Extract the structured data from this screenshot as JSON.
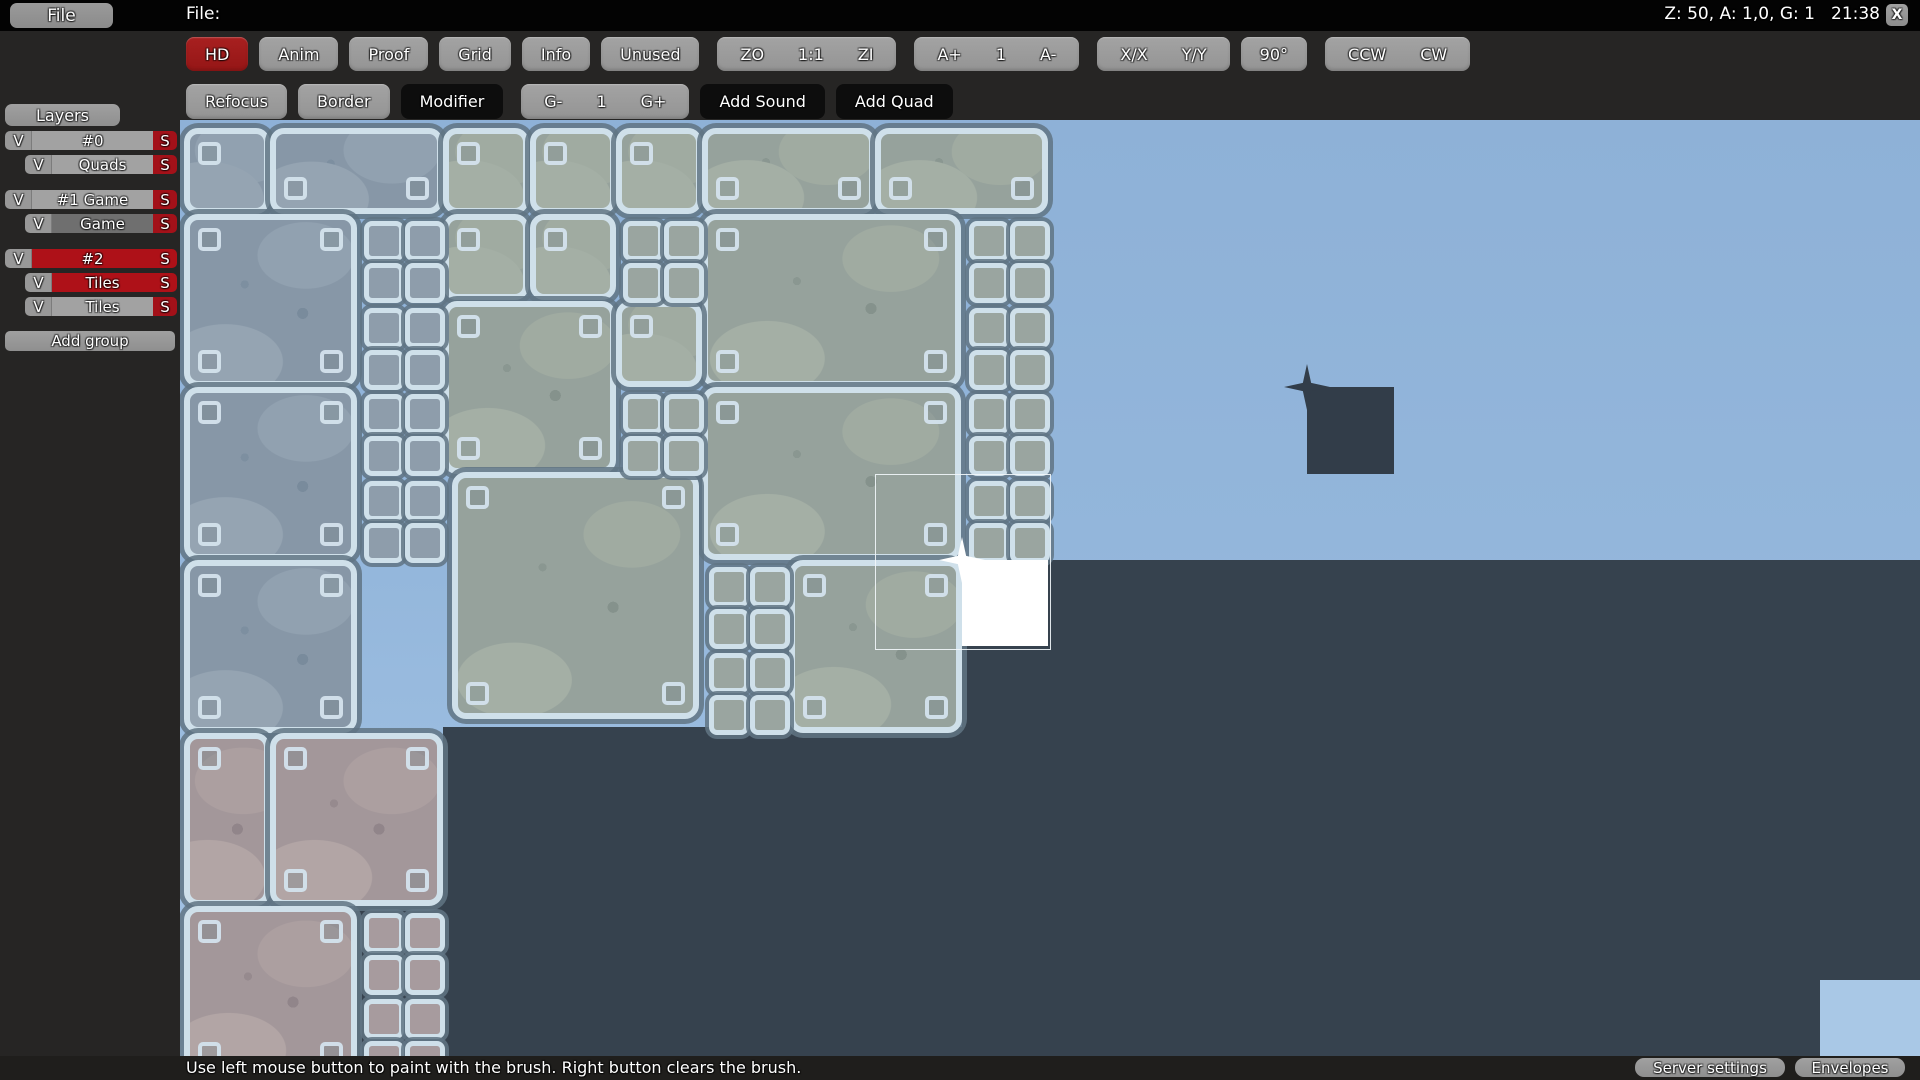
{
  "topbar": {
    "file_button": "File",
    "file_label": "File:",
    "zoom_info": "Z: 50, A: 1,0, G: 1",
    "clock": "21:38",
    "close": "X"
  },
  "toolbar": {
    "row1": [
      {
        "kind": "button",
        "label": "HD",
        "variant": "red",
        "name": "hd-toggle"
      },
      {
        "kind": "button",
        "label": "Anim",
        "variant": "grey",
        "name": "anim-toggle"
      },
      {
        "kind": "button",
        "label": "Proof",
        "variant": "grey",
        "name": "proof-toggle"
      },
      {
        "kind": "button",
        "label": "Grid",
        "variant": "grey",
        "name": "grid-toggle"
      },
      {
        "kind": "button",
        "label": "Info",
        "variant": "grey",
        "name": "info-toggle"
      },
      {
        "kind": "button",
        "label": "Unused",
        "variant": "grey",
        "name": "unused-toggle"
      },
      {
        "kind": "group",
        "name": "zoom-group",
        "labels": [
          "ZO",
          "1:1",
          "ZI"
        ]
      },
      {
        "kind": "group",
        "name": "animation-speed-group",
        "labels": [
          "A+",
          "1",
          "A-"
        ]
      },
      {
        "kind": "group",
        "name": "flip-group",
        "labels": [
          "X/X",
          "Y/Y"
        ]
      },
      {
        "kind": "button",
        "label": "90°",
        "variant": "grey",
        "name": "rotate-amount-button"
      },
      {
        "kind": "group",
        "name": "rotate-group",
        "labels": [
          "CCW",
          "CW"
        ]
      }
    ],
    "row2": [
      {
        "kind": "button",
        "label": "Refocus",
        "variant": "grey",
        "name": "refocus-button"
      },
      {
        "kind": "button",
        "label": "Border",
        "variant": "grey",
        "name": "border-button"
      },
      {
        "kind": "button",
        "label": "Modifier",
        "variant": "dark",
        "name": "modifier-button"
      },
      {
        "kind": "group",
        "name": "grid-size-group",
        "labels": [
          "G-",
          "1",
          "G+"
        ]
      },
      {
        "kind": "button",
        "label": "Add Sound",
        "variant": "dark",
        "name": "add-sound-button"
      },
      {
        "kind": "button",
        "label": "Add Quad",
        "variant": "dark",
        "name": "add-quad-button"
      }
    ]
  },
  "layers": {
    "header": "Layers",
    "visibility_label": "V",
    "save_label": "S",
    "rows": [
      {
        "label": "#0",
        "indent": false,
        "style": "grey",
        "gap_after": false
      },
      {
        "label": "Quads",
        "indent": true,
        "style": "grey",
        "gap_after": true
      },
      {
        "label": "#1 Game",
        "indent": false,
        "style": "grey",
        "gap_after": false
      },
      {
        "label": "Game",
        "indent": true,
        "style": "darkgrey",
        "gap_after": true
      },
      {
        "label": "#2",
        "indent": false,
        "style": "red",
        "gap_after": false
      },
      {
        "label": "Tiles",
        "indent": true,
        "style": "red",
        "gap_after": false
      },
      {
        "label": "Tiles",
        "indent": true,
        "style": "grey",
        "gap_after": false
      }
    ],
    "add_group": "Add group"
  },
  "statusbar": {
    "hint": "Use left mouse button to paint with the brush. Right button clears the brush.",
    "server_settings": "Server settings",
    "envelopes": "Envelopes"
  },
  "colors": {
    "accent_red": "#9e1b1b",
    "selected_red": "#ae1118",
    "sky_top": "#8eb1d7",
    "sky_bottom": "#a5c5e6",
    "underground": "#36424e",
    "tile_border": "#cfe0ea",
    "tile_blue": "#8797a7",
    "tile_green": "#96a29c",
    "tile_pink": "#a3979a",
    "white_tile": "#ffffff",
    "dark_tile": "#323d49",
    "corner_blue": "#a9c8e6"
  },
  "canvas": {
    "dark_rects": [
      {
        "x": 868,
        "y": 440,
        "w": 872,
        "h": 496
      },
      {
        "x": 782,
        "y": 526,
        "w": 86,
        "h": 410
      },
      {
        "x": 263,
        "y": 607,
        "w": 606,
        "h": 329
      },
      {
        "x": 174,
        "y": 770,
        "w": 90,
        "h": 166
      }
    ],
    "corner_rect": {
      "x": 1640,
      "y": 860,
      "w": 100,
      "h": 76
    },
    "tiles": [
      {
        "x": 4,
        "y": 8,
        "w": 86,
        "h": 86,
        "v": "b"
      },
      {
        "x": 90,
        "y": 8,
        "w": 173,
        "h": 86,
        "v": "b"
      },
      {
        "x": 263,
        "y": 8,
        "w": 86,
        "h": 86,
        "v": "g"
      },
      {
        "x": 350,
        "y": 8,
        "w": 86,
        "h": 86,
        "v": "g"
      },
      {
        "x": 436,
        "y": 8,
        "w": 86,
        "h": 86,
        "v": "g"
      },
      {
        "x": 522,
        "y": 8,
        "w": 173,
        "h": 86,
        "v": "g"
      },
      {
        "x": 695,
        "y": 8,
        "w": 173,
        "h": 86,
        "v": "g"
      },
      {
        "x": 4,
        "y": 94,
        "w": 173,
        "h": 173,
        "v": "b"
      },
      {
        "x": 263,
        "y": 94,
        "w": 86,
        "h": 86,
        "v": "g"
      },
      {
        "x": 350,
        "y": 94,
        "w": 86,
        "h": 86,
        "v": "g"
      },
      {
        "x": 522,
        "y": 94,
        "w": 259,
        "h": 173,
        "v": "g"
      },
      {
        "x": 263,
        "y": 181,
        "w": 173,
        "h": 173,
        "v": "g"
      },
      {
        "x": 436,
        "y": 181,
        "w": 86,
        "h": 86,
        "v": "g"
      },
      {
        "x": 4,
        "y": 267,
        "w": 173,
        "h": 173,
        "v": "b"
      },
      {
        "x": 522,
        "y": 267,
        "w": 259,
        "h": 173,
        "v": "g"
      },
      {
        "x": 272,
        "y": 352,
        "w": 247,
        "h": 247,
        "v": "g"
      },
      {
        "x": 4,
        "y": 440,
        "w": 173,
        "h": 173,
        "v": "b"
      },
      {
        "x": 609,
        "y": 440,
        "w": 173,
        "h": 173,
        "v": "g"
      },
      {
        "x": 4,
        "y": 613,
        "w": 86,
        "h": 173,
        "v": "p"
      },
      {
        "x": 90,
        "y": 613,
        "w": 173,
        "h": 173,
        "v": "p"
      },
      {
        "x": 4,
        "y": 786,
        "w": 173,
        "h": 173,
        "v": "p"
      }
    ],
    "quads": [
      {
        "x": 177,
        "y": 94,
        "v": "b"
      },
      {
        "x": 436,
        "y": 94,
        "v": "g"
      },
      {
        "x": 782,
        "y": 94,
        "v": "g"
      },
      {
        "x": 177,
        "y": 181,
        "v": "b"
      },
      {
        "x": 782,
        "y": 181,
        "v": "g"
      },
      {
        "x": 177,
        "y": 267,
        "v": "b"
      },
      {
        "x": 436,
        "y": 267,
        "v": "g"
      },
      {
        "x": 782,
        "y": 267,
        "v": "g"
      },
      {
        "x": 177,
        "y": 354,
        "v": "b"
      },
      {
        "x": 782,
        "y": 354,
        "v": "g"
      },
      {
        "x": 522,
        "y": 440,
        "v": "g"
      },
      {
        "x": 522,
        "y": 526,
        "v": "g"
      },
      {
        "x": 177,
        "y": 786,
        "v": "p"
      },
      {
        "x": 177,
        "y": 872,
        "v": "p"
      }
    ],
    "white_tile": {
      "x": 782,
      "y": 440,
      "w": 86,
      "h": 86
    },
    "dark_square": {
      "x": 1127,
      "y": 267,
      "w": 87,
      "h": 87
    },
    "brush_outline": {
      "x": 695,
      "y": 354,
      "w": 174,
      "h": 174
    }
  }
}
